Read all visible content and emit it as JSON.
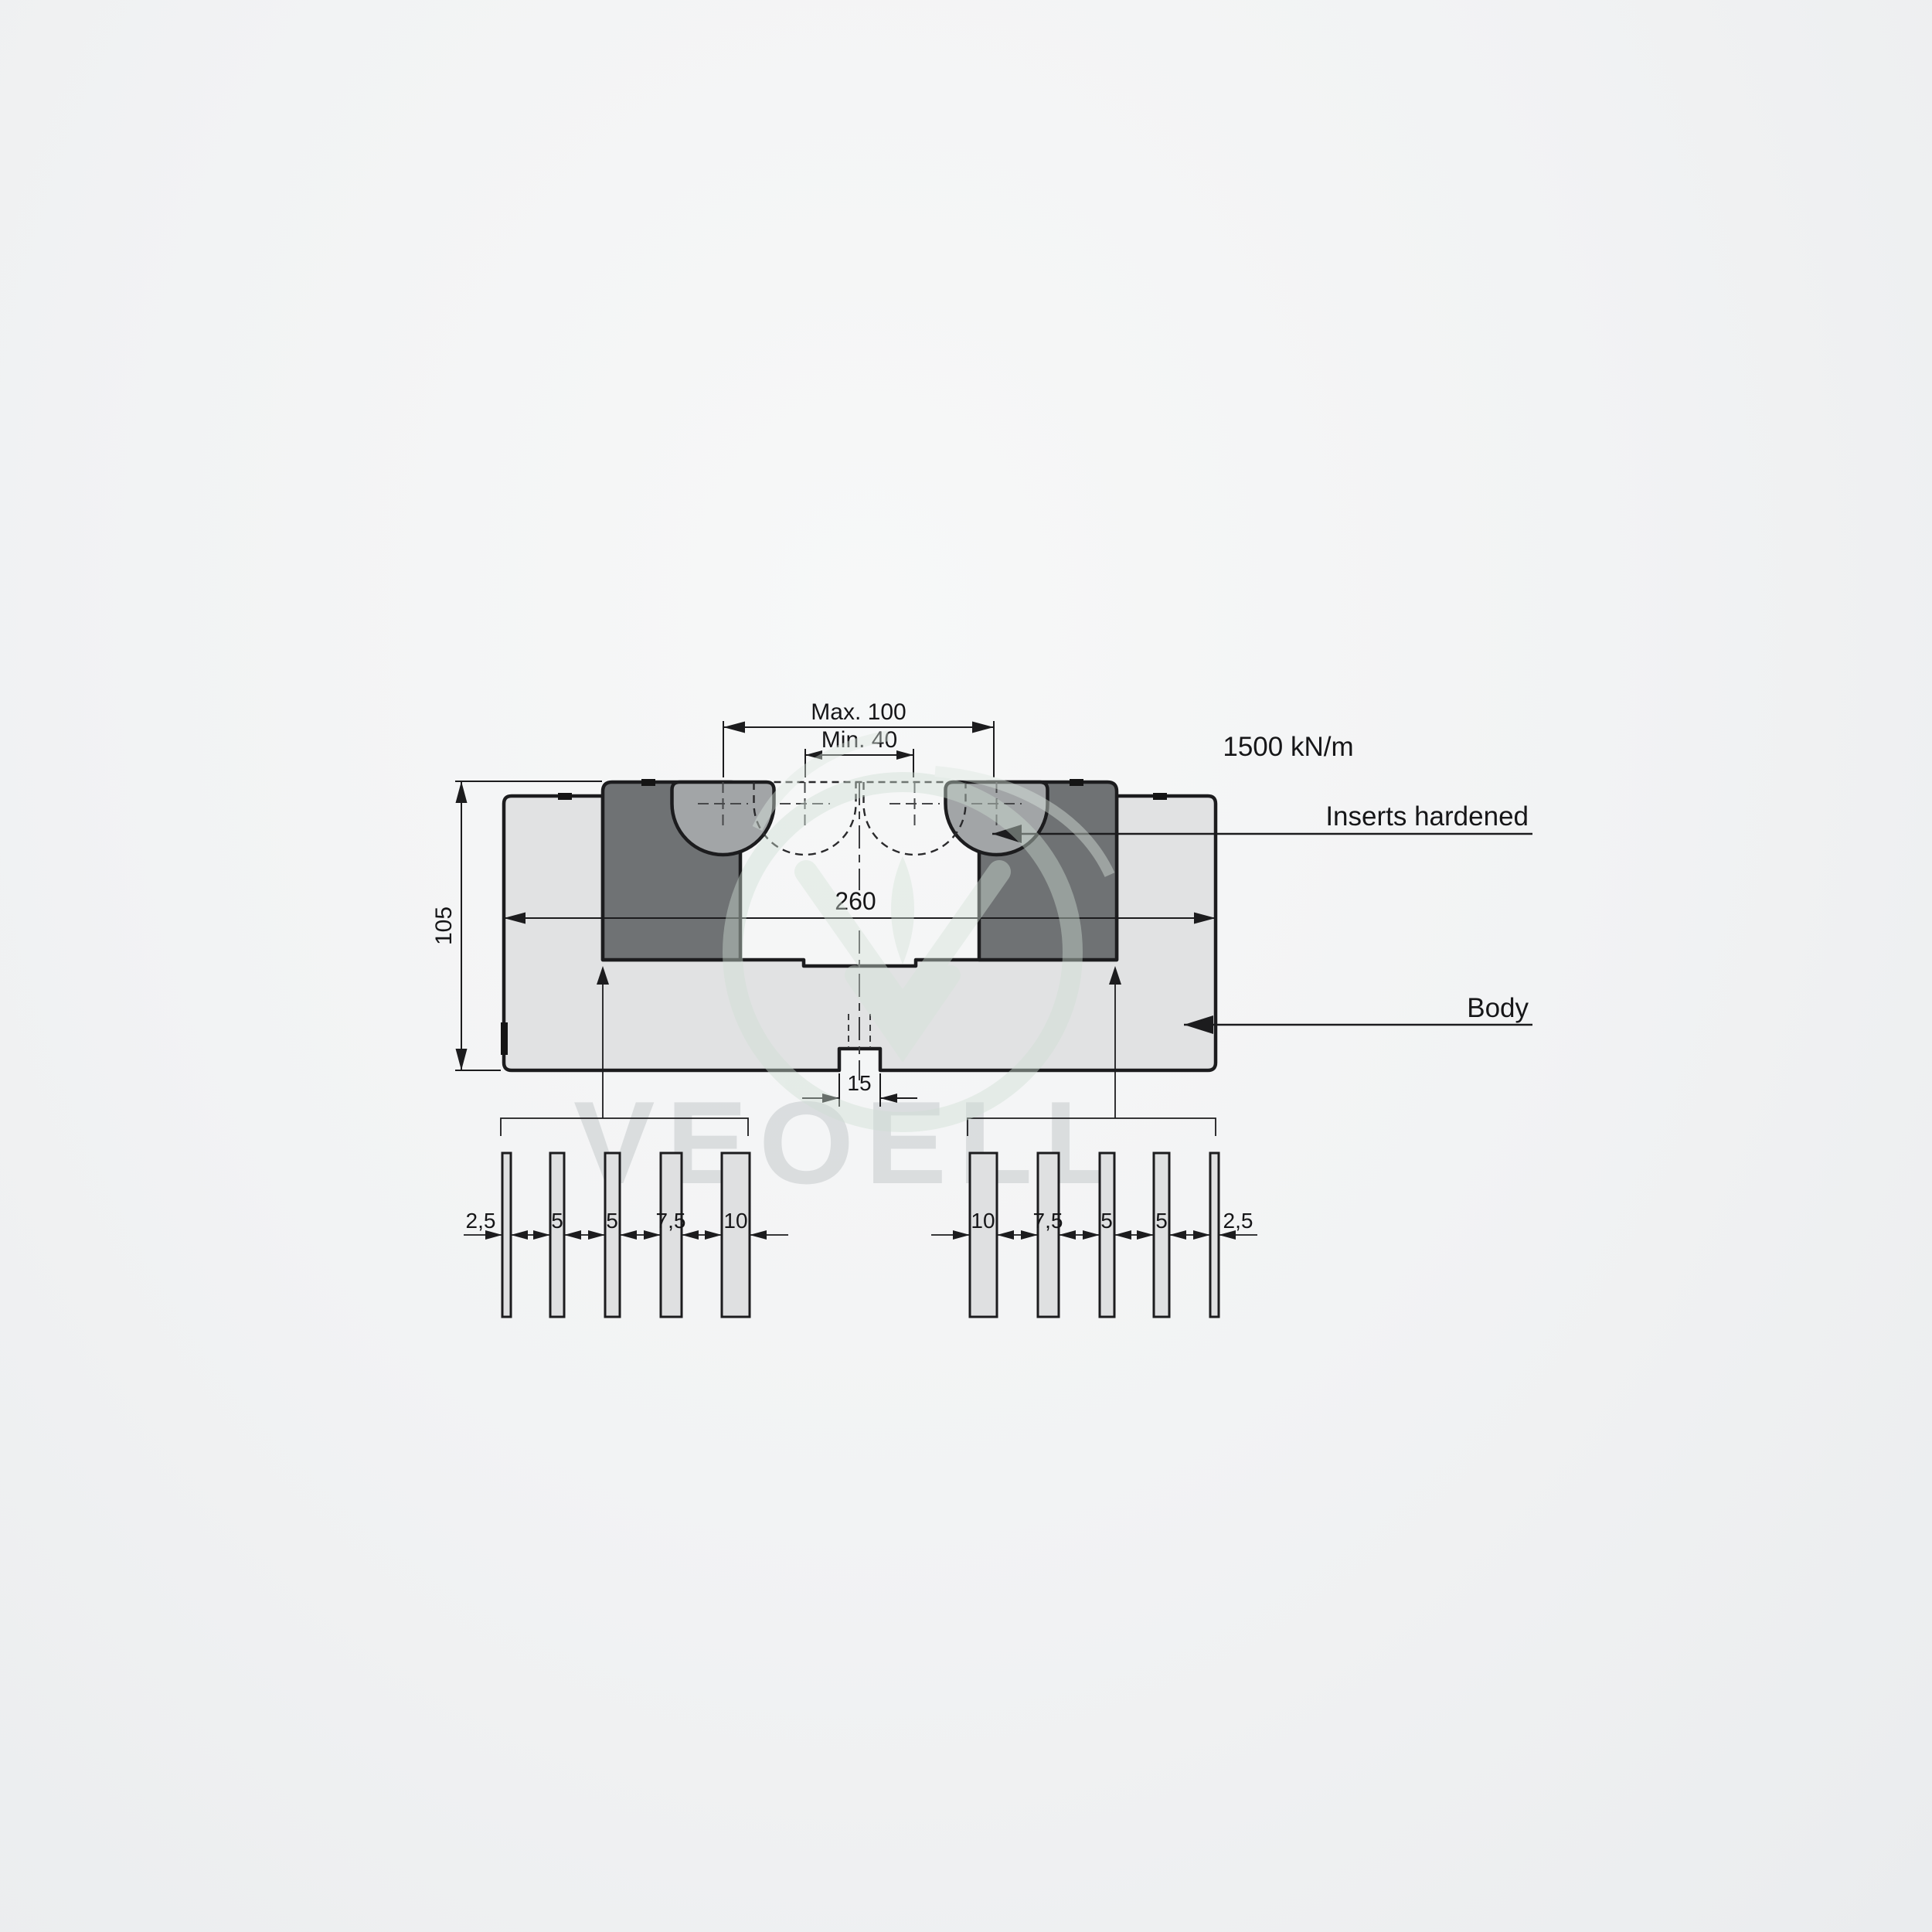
{
  "drawing": {
    "force_rating": "1500 kN/m",
    "dims": {
      "max_opening": "Max. 100",
      "min_opening": "Min. 40",
      "body_width": "260",
      "body_height": "105",
      "base_slot_width": "15"
    },
    "callouts": {
      "inserts": "Inserts hardened",
      "body": "Body"
    },
    "shim_sets": {
      "left": {
        "labels": [
          "2,5",
          "5",
          "5",
          "7,5",
          "10"
        ]
      },
      "right": {
        "labels": [
          "10",
          "7,5",
          "5",
          "5",
          "2,5"
        ]
      }
    },
    "watermark": {
      "text": "VEOELL"
    },
    "colors": {
      "body_fill": "#e1e2e3",
      "holder_fill": "#6f7274",
      "insert_fill": "#a2a5a7",
      "line": "#1c1c1e",
      "watermark_text": "#d6d9db",
      "watermark_logo": "#cfdfd4"
    }
  }
}
